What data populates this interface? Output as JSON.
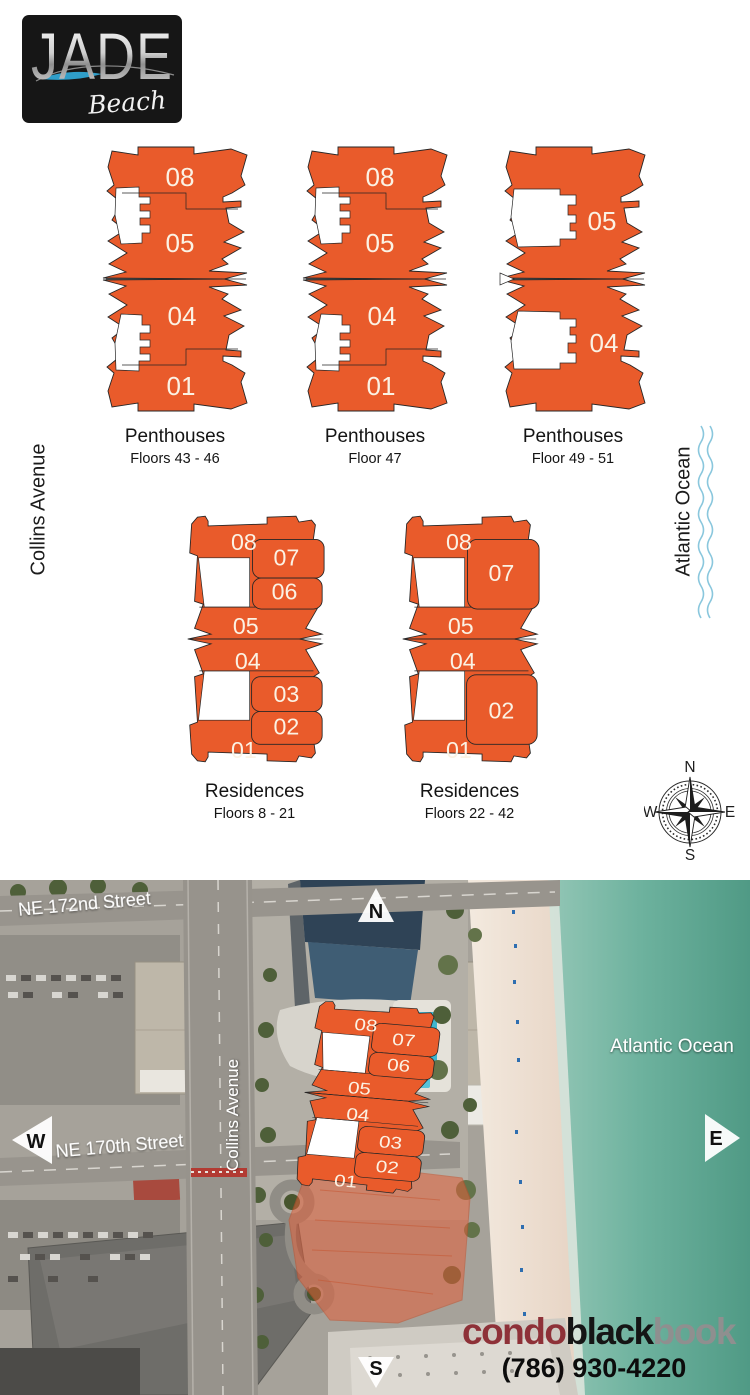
{
  "logo": {
    "title": "JADE",
    "subtitle": "Beach"
  },
  "sides": {
    "collins": "Collins Avenue",
    "ocean": "Atlantic Ocean"
  },
  "compass": {
    "n": "N",
    "e": "E",
    "s": "S",
    "w": "W"
  },
  "plates": [
    {
      "title": "Penthouses",
      "subtitle": "Floors 43 - 46",
      "units": [
        "08",
        "05",
        "04",
        "01"
      ]
    },
    {
      "title": "Penthouses",
      "subtitle": "Floor 47",
      "units": [
        "08",
        "05",
        "04",
        "01"
      ]
    },
    {
      "title": "Penthouses",
      "subtitle": "Floor 49 - 51",
      "units": [
        "05",
        "04"
      ]
    },
    {
      "title": "Residences",
      "subtitle": "Floors 8 - 21",
      "units": [
        "08",
        "07",
        "06",
        "05",
        "04",
        "03",
        "02",
        "01"
      ]
    },
    {
      "title": "Residences",
      "subtitle": "Floors 22 - 42",
      "units": [
        "08",
        "07",
        "05",
        "04",
        "02",
        "01"
      ]
    }
  ],
  "map": {
    "street_172": "NE 172nd Street",
    "street_170": "NE 170th Street",
    "collins": "Collins Avenue",
    "ocean": "Atlantic Ocean",
    "markers": {
      "n": "N",
      "s": "S",
      "e": "E",
      "w": "W"
    },
    "overlay_units": [
      "08",
      "07",
      "06",
      "05",
      "04",
      "03",
      "02",
      "01"
    ],
    "brand": {
      "condo": "condo",
      "black": "black",
      "book": "book",
      "phone": "(786) 930-4220"
    }
  },
  "colors": {
    "accent": "#E95B2B",
    "unit_text": "#FBF2E4",
    "wave_blue": "#8AC7DD",
    "ocean_teal": "#5FA893",
    "brand_red": "#8E3138",
    "brand_gray": "#8F8F8F"
  }
}
